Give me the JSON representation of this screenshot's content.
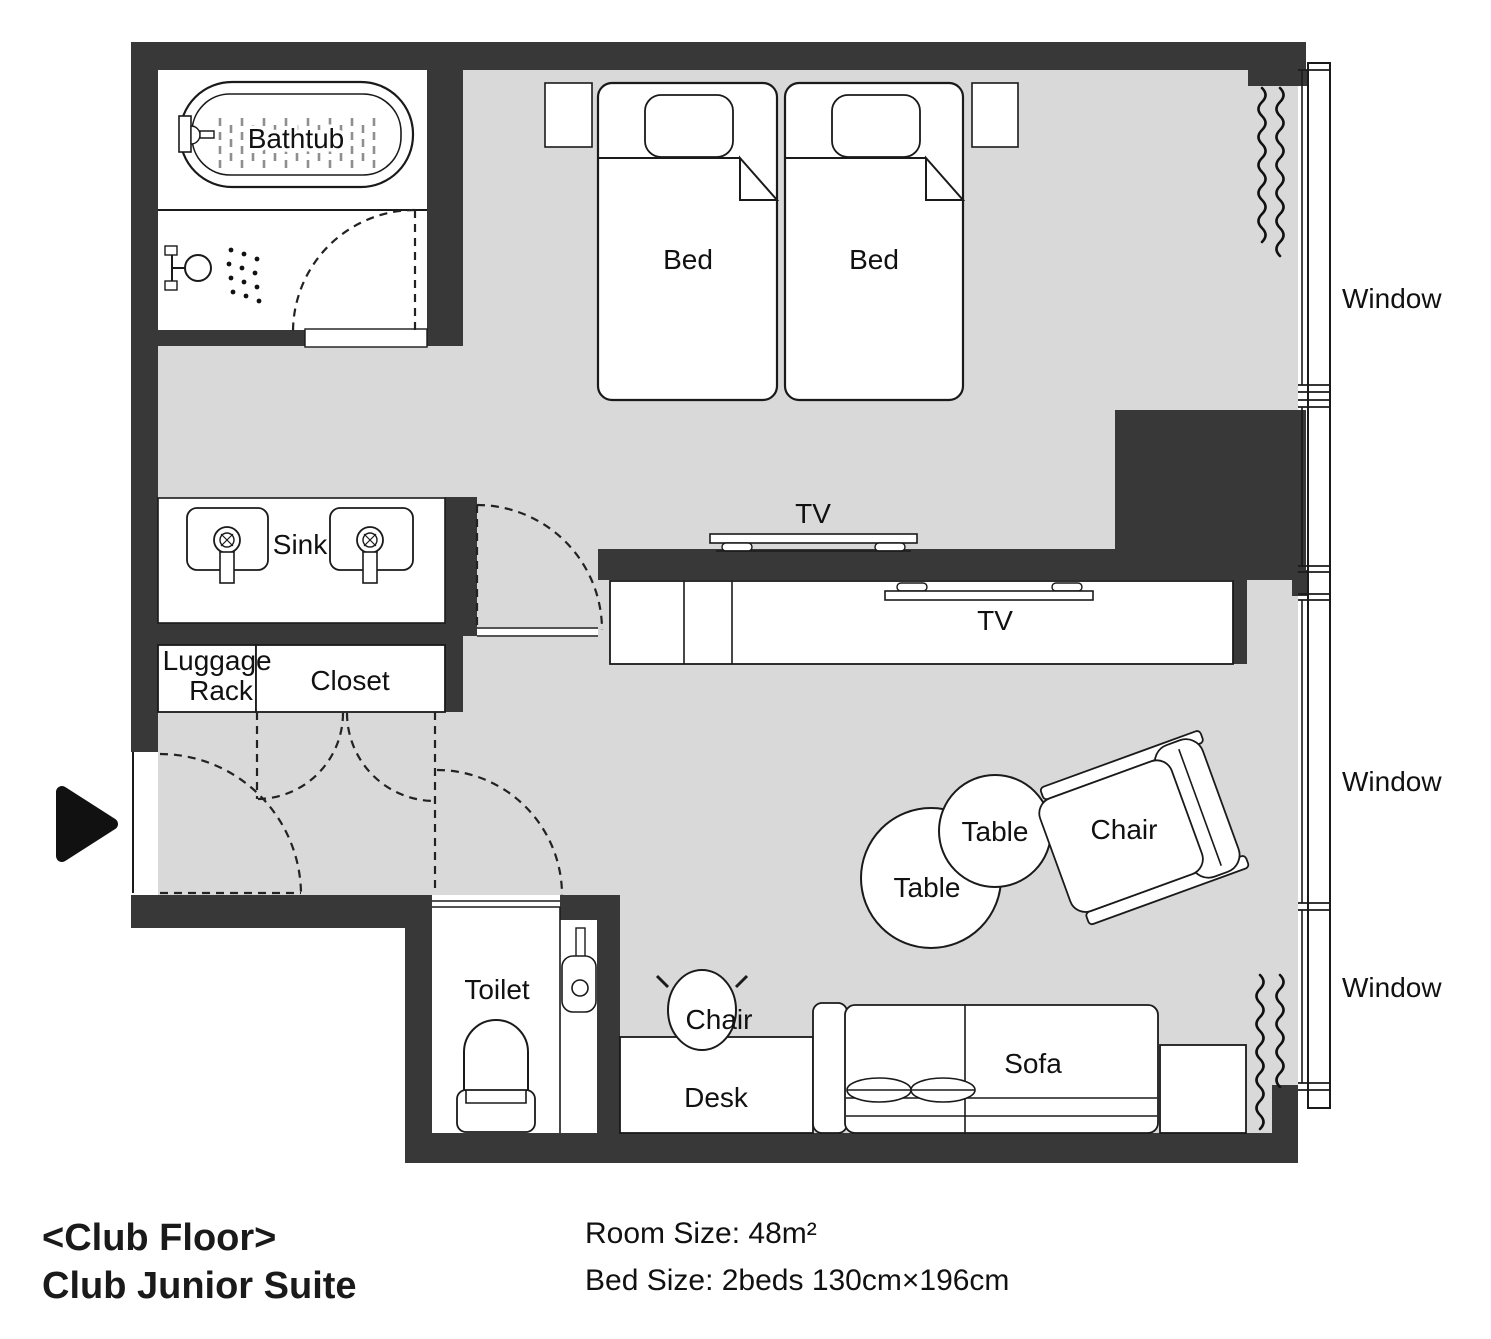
{
  "floorplan": {
    "footer": {
      "title_line1": "<Club Floor>",
      "title_line2": "Club Junior Suite",
      "room_size": "Room Size: 48m²",
      "bed_size": "Bed Size: 2beds 130cm×196cm"
    },
    "labels": {
      "bathtub": "Bathtub",
      "bed_left": "Bed",
      "bed_right": "Bed",
      "sink": "Sink",
      "luggage_line1": "Luggage",
      "luggage_line2": "Rack",
      "closet": "Closet",
      "tv_bedroom": "TV",
      "tv_living": "TV",
      "window_top": "Window",
      "window_middle": "Window",
      "window_bottom": "Window",
      "table_large": "Table",
      "table_small": "Table",
      "armchair": "Chair",
      "desk_chair": "Chair",
      "toilet": "Toilet",
      "desk": "Desk",
      "sofa": "Sofa"
    },
    "colors": {
      "wall": "#383838",
      "floor": "#d9d9d9",
      "line": "#1a1a1a",
      "page": "#ffffff"
    }
  }
}
